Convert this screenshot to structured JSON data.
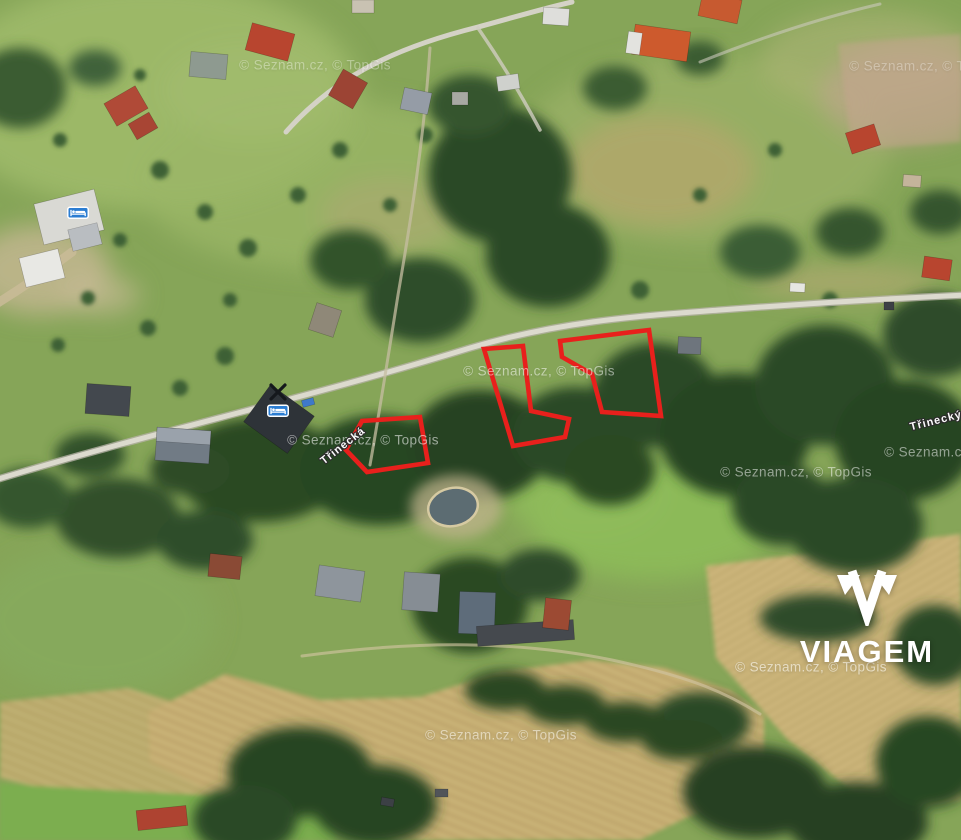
{
  "map": {
    "provider_attribution": "© Seznam.cz, © TopGis",
    "highlight_color": "#e8201c",
    "watermarks": [
      {
        "x": 315,
        "y": 65,
        "opacity": 0.35
      },
      {
        "x": 925,
        "y": 66,
        "opacity": 0.3
      },
      {
        "x": 539,
        "y": 371,
        "opacity": 0.5
      },
      {
        "x": 363,
        "y": 440,
        "opacity": 0.55
      },
      {
        "x": 796,
        "y": 472,
        "opacity": 0.5
      },
      {
        "x": 960,
        "y": 452,
        "opacity": 0.5
      },
      {
        "x": 811,
        "y": 667,
        "opacity": 0.55
      },
      {
        "x": 501,
        "y": 735,
        "opacity": 0.5
      }
    ],
    "road_labels": [
      {
        "text": "Třinecká",
        "x": 343,
        "y": 446,
        "rotation": -38
      },
      {
        "text": "Třinecký",
        "x": 936,
        "y": 421,
        "rotation": -14
      }
    ],
    "plots": [
      {
        "id": "plot-west",
        "points": "346,450 362,421 420,417 428,463 367,472"
      },
      {
        "id": "plot-middle",
        "points": "484,349 523,346 531,411 569,419 565,437 513,446"
      },
      {
        "id": "plot-east",
        "points": "560,341 649,330 661,416 602,412 592,374 562,357"
      }
    ],
    "poi_icons": [
      {
        "type": "bed",
        "x": 78,
        "y": 213
      },
      {
        "type": "bed",
        "x": 278,
        "y": 411
      },
      {
        "type": "crossed-tools",
        "x": 278,
        "y": 392
      }
    ]
  },
  "branding": {
    "name": "VIAGEM"
  }
}
